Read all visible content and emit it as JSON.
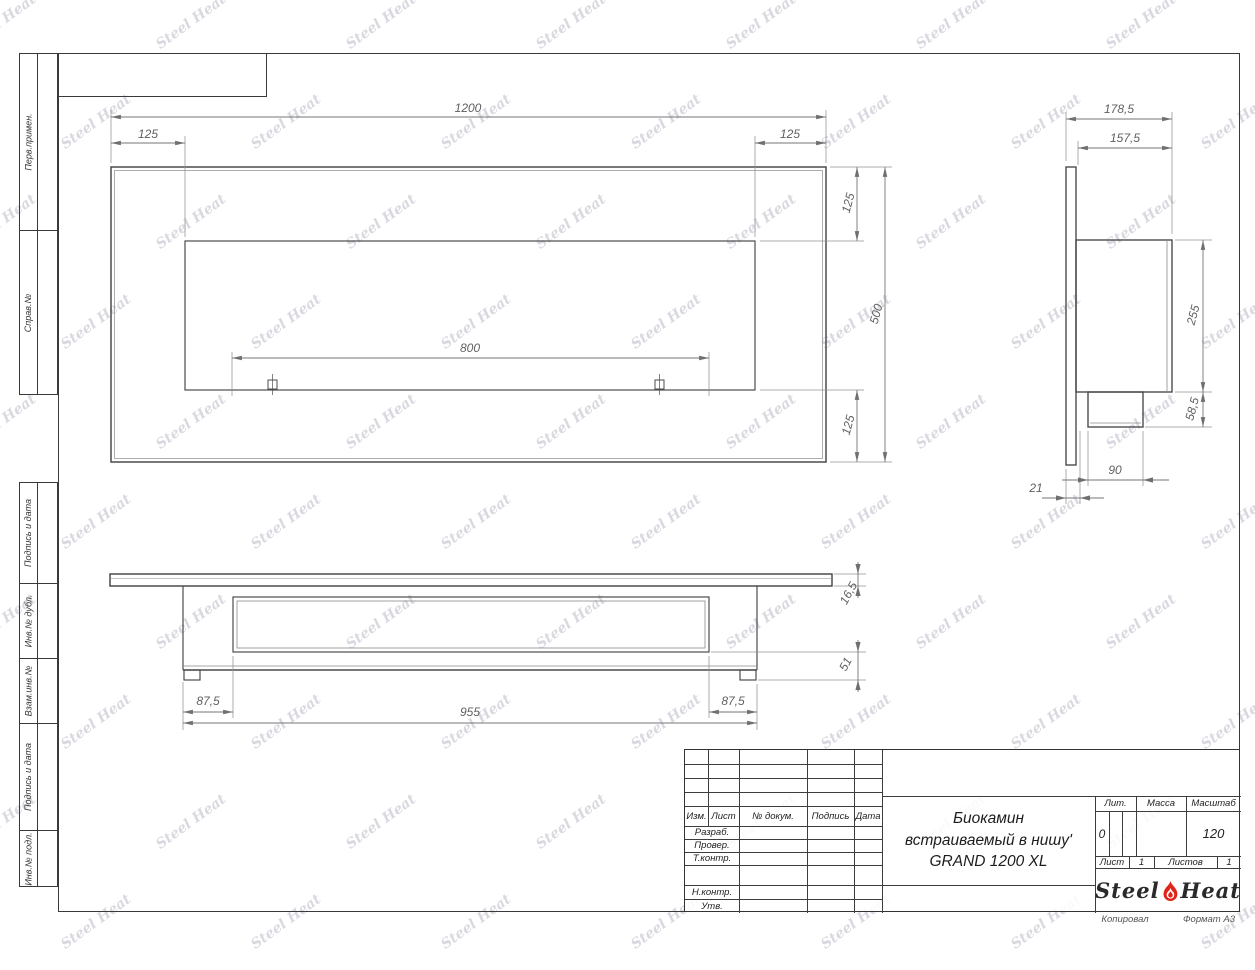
{
  "watermark": {
    "text": "Steel Heat"
  },
  "strips": {
    "upper": [
      {
        "label": "Перв.примен."
      },
      {
        "label": "Справ.№"
      }
    ],
    "lower": [
      {
        "label": "Подпись и дата"
      },
      {
        "label": "Инв.№ дубл."
      },
      {
        "label": "Взам.инв.№"
      },
      {
        "label": "Подпись и дата"
      },
      {
        "label": "Инв.№ подл."
      }
    ]
  },
  "views": {
    "front": {
      "dims": {
        "total_width": "1200",
        "offset_left": "125",
        "offset_right": "125",
        "burner_width": "800",
        "offset_top": "125",
        "total_height": "500",
        "offset_bottom": "125"
      }
    },
    "side": {
      "dims": {
        "total_depth": "178,5",
        "body_depth": "157,5",
        "body_height": "255",
        "tray_height": "58,5",
        "tray_width": "90",
        "flange_gap": "21"
      }
    },
    "plan": {
      "dims": {
        "inset_left": "87,5",
        "body_length": "955",
        "inset_right": "87,5",
        "plate_thickness": "16,5",
        "rear_height": "51"
      }
    }
  },
  "title_block": {
    "revision_header": [
      "Изм.",
      "Лист",
      "№ докум.",
      "Подпись",
      "Дата"
    ],
    "signature_rows": [
      "Разраб.",
      "Провер.",
      "Т.контр.",
      "Н.контр.",
      "Утв."
    ],
    "title_lines": [
      "Биокамин",
      "встраиваемый в нишу'",
      "GRAND 1200 XL"
    ],
    "lit_label": "Лит.",
    "lit_value": "0",
    "mass_label": "Масса",
    "mass_value": "",
    "scale_label": "Масштаб",
    "scale_value": "120",
    "sheet_label": "Лист",
    "sheet_value": "1",
    "sheets_label": "Листов",
    "sheets_value": "1",
    "brand": {
      "word1": "Steel",
      "word2": "Heat"
    }
  },
  "footer": {
    "copied": "Копировал",
    "format": "Формат А3"
  }
}
